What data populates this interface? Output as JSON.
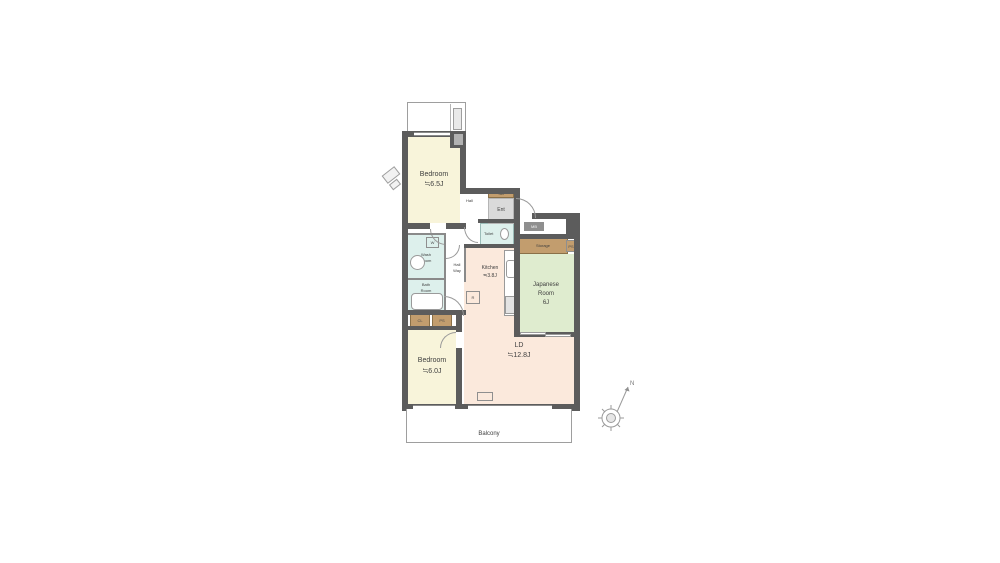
{
  "floor_plan": {
    "rooms": {
      "bedroom_top": {
        "name": "Bedroom",
        "size": "≒6.5J"
      },
      "bedroom_bottom": {
        "name": "Bedroom",
        "size": "≒6.0J"
      },
      "living_dining": {
        "name": "LD",
        "size": "≒12.8J"
      },
      "kitchen": {
        "name": "Kitchen",
        "size": "≒3.8J"
      },
      "japanese_room": {
        "line1": "Japanese",
        "line2": "Room",
        "size": "6J"
      },
      "wash_room": {
        "line1": "Wash",
        "line2": "Room"
      },
      "bath_room": {
        "line1": "Bath",
        "line2": "Room"
      },
      "toilet": {
        "name": "Toilet"
      },
      "hall": {
        "name": "Hall"
      },
      "hallway": {
        "line1": "Hall",
        "line2": "Way"
      },
      "entrance": {
        "name": "Ent"
      },
      "storage": {
        "name": "Storage"
      },
      "balcony": {
        "name": "Balcony"
      }
    },
    "fixtures": {
      "shoe_box": "SB",
      "meter_box": "MB",
      "washer": "W",
      "refrigerator": "R",
      "closet": "CL",
      "pipe_space_a": "PS",
      "pipe_space_b": "PS",
      "compass_north": "N"
    }
  },
  "colors": {
    "wall": "#5c5c5c",
    "bedroom": "#f8f4da",
    "living": "#fbe9dc",
    "japanese": "#dfeccf",
    "wet": "#ddf0ec",
    "storage_tan": "#c29d6e",
    "entrance_gray": "#dadada"
  }
}
